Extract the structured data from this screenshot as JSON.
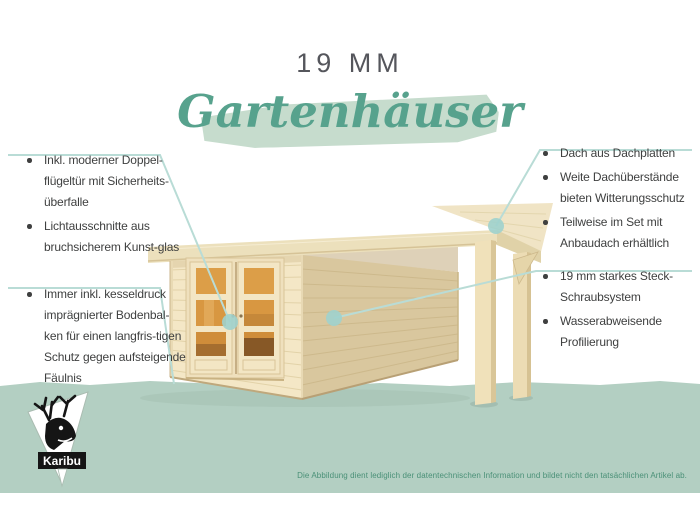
{
  "header": {
    "title": "19 MM",
    "subtitle": "Gartenhäuser"
  },
  "callouts": {
    "left_top": {
      "items": [
        "Inkl. moderner Doppel-flügeltür mit Sicherheits-überfalle",
        "Lichtausschnitte aus bruchsicherem Kunst-glas"
      ]
    },
    "left_bottom": {
      "items": [
        "Immer inkl. kesseldruck imprägnierter Bodenbal-ken für einen langfris-tigen Schutz gegen aufsteigende Fäulnis"
      ]
    },
    "right_top": {
      "items": [
        "Dach aus Dachplatten",
        "Weite Dachüberstände bieten Witterungsschutz",
        "Teilweise im Set mit Anbaudach erhältlich"
      ]
    },
    "right_bottom": {
      "items": [
        "19 mm starkes Steck-Schraubsystem",
        "Wasserabweisende Profilierung"
      ]
    }
  },
  "illustration": {
    "subject": "Wooden flat-roof garden house with glazed double door and attached side canopy (Anbaudach) on two posts"
  },
  "footer": {
    "logo_text": "Karibu",
    "disclaimer": "Die Abbildung dient lediglich der datentechnischen Information und bildet nicht den tatsächlichen Artikel ab."
  },
  "colors": {
    "script_teal": "#57a28d",
    "brush_green": "#c6dccd",
    "ground_green": "#b3cfc2",
    "callout_line": "#b9dcd6",
    "callout_dot": "#9ed2cd",
    "text_dark": "#3f4040",
    "title_gray": "#55565c",
    "disclaimer_green": "#4a9077",
    "wood_light": "#f4e7c6",
    "wood_side": "#d9c79e",
    "window_amber": "#dc9e48"
  }
}
